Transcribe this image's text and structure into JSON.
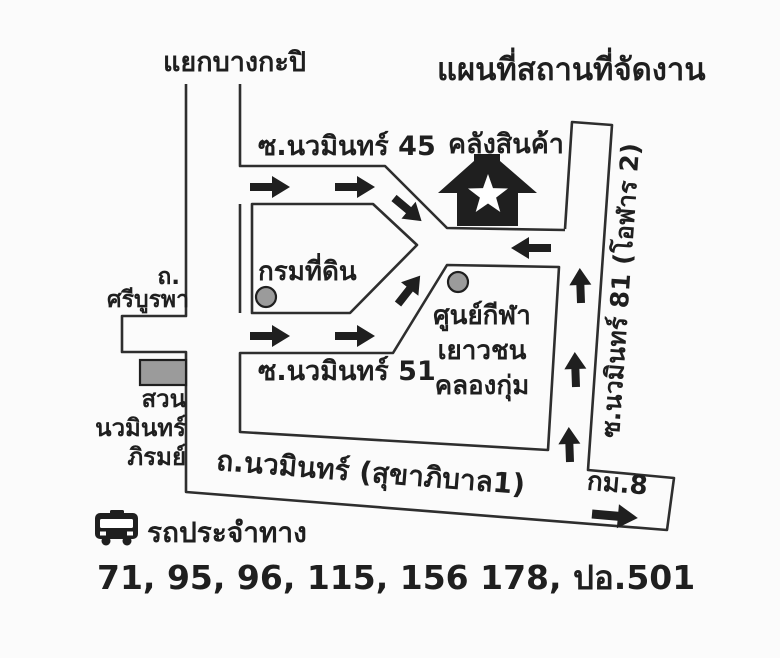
{
  "colors": {
    "ink": "#1f1f1f",
    "road_line": "#2e2e2e",
    "marker_gray": "#9b9b9b",
    "background": "#fbfbfb"
  },
  "header": {
    "title": "แผนที่สถานที่จัดงาน",
    "junction_label": "แยกบางกะปิ"
  },
  "map": {
    "roads": {
      "soi_45": "ซ.นวมินทร์ 45",
      "soi_51": "ซ.นวมินทร์ 51",
      "soi_81": "ซ.นวมินทร์ 81 (โอฬาร 2)",
      "nawamin_road": "ถ.นวมินทร์ (สุขาภิบาล1)",
      "sri_burapha": [
        "ถ.",
        "ศรีบูรพา"
      ],
      "km_8": "กม.8"
    },
    "places": {
      "warehouse": "คลังสินค้า",
      "land_department": "กรมที่ดิน",
      "sports_center": [
        "ศูนย์กีฬา",
        "เยาวชน",
        "คลองกุ่ม"
      ],
      "park": [
        "สวน",
        "นวมินทร์",
        "ภิรมย์"
      ]
    }
  },
  "bus": {
    "legend": "รถประจำทาง",
    "routes": "71, 95, 96, 115, 156 178, ปอ.501"
  },
  "icons": {
    "venue": "house-with-star-icon",
    "bus": "bus-front-icon"
  }
}
